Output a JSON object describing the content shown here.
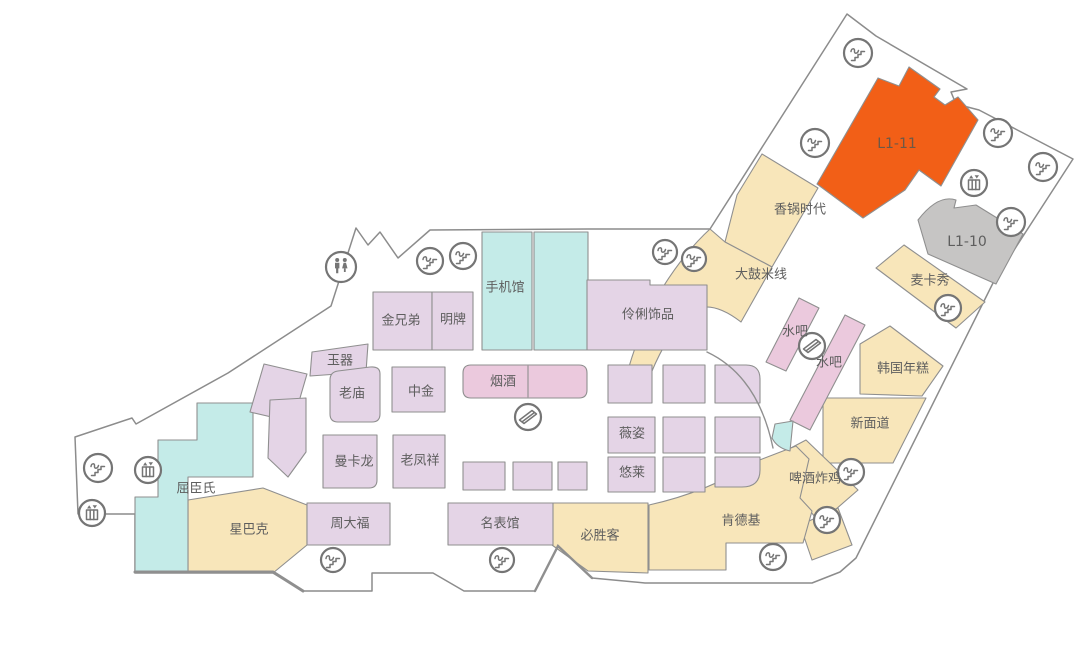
{
  "page": {
    "background": "#ffffff"
  },
  "map": {
    "width": 1089,
    "height": 652,
    "palette": {
      "floor": "#ffffff",
      "outline": "#8c8c8c",
      "tan": "#f8e6ba",
      "lavender": "#e4d4e6",
      "pink": "#ebc9dd",
      "cyan": "#c4ebe8",
      "orange": "#f25f17",
      "gray": "#c6c5c4",
      "room_stroke": "#8f8f8f",
      "label": "#5e5e5e",
      "icon": "#757575",
      "l1_11_text": "#6d5847"
    },
    "outline_path": "M75,437 L132,418 L136,424 L228,373 L331,306 L356,228 L368,245 L380,232 L398,258 L430,230 L588,229 L710,229 L847,14 L876,36 L967,89 L951,92 L956,104 L979,110 L1073,159 L994,281 L856,558 L840,572 L812,583 L645,583 L592,578 L558,546 L535,591 L464,591 L433,573 L372,573 L372,591 L303,591 L273,573 L135,573 L135,514 L78,514 Z",
    "rooms": [
      {
        "id": "xiangguoshidai",
        "label": "香锅时代",
        "fill": "tan",
        "path": "M737,195 L762,154 L818,188 L772,267 L725,242 Z",
        "lx": 800,
        "ly": 210
      },
      {
        "id": "dagumixian",
        "label": "大鼓米线",
        "fill": "tan",
        "path": "M710,229 L725,242 L772,267 L741,322 Q705,294 683,318 Q662,344 648,381 L628,370 Q642,322 663,287 Q685,252 710,229 Z",
        "lx": 761,
        "ly": 275
      },
      {
        "id": "l1-11",
        "label": "L1-11",
        "fill": "orange",
        "path": "M817,184 L878,78 L899,86 L909,67 L940,89 L934,97 L945,105 L958,97 L978,120 L941,186 L919,170 L905,190 L863,218 Z",
        "lx": 897,
        "ly": 144,
        "fs": 14,
        "tc": "l1_11_text"
      },
      {
        "id": "l1-10",
        "label": "L1-10",
        "fill": "gray",
        "path": "M918,220 Q938,194 956,200 L954,208 L976,205 L1023,234 L996,284 L928,254 Z",
        "lx": 967,
        "ly": 242,
        "fs": 14
      },
      {
        "id": "maikaxiu",
        "label": "麦卡秀",
        "fill": "tan",
        "path": "M876,268 L904,245 L985,302 L956,328 Z",
        "lx": 930,
        "ly": 281
      },
      {
        "id": "hanguoniangao",
        "label": "韩国年糕",
        "fill": "tan",
        "path": "M860,344 L890,326 L943,366 L922,396 L860,394 Z",
        "lx": 903,
        "ly": 369
      },
      {
        "id": "xinmiandao",
        "label": "新面道",
        "fill": "tan",
        "path": "M823,398 L926,398 L893,463 L823,463 Z",
        "lx": 870,
        "ly": 424
      },
      {
        "id": "shuiba-1",
        "label": "水吧",
        "fill": "pink",
        "path": "M766,362 L799,298 L819,308 L786,371 Z",
        "lx": 795,
        "ly": 332
      },
      {
        "id": "shuiba-2",
        "label": "水吧",
        "fill": "pink",
        "path": "M790,420 L845,315 L865,325 L810,430 Z",
        "lx": 829,
        "ly": 363
      },
      {
        "id": "pijiuzhaji",
        "label": "啤酒炸鸡",
        "fill": "tan",
        "path": "M768,460 L806,440 L858,490 L820,523 Z",
        "lx": 815,
        "ly": 479
      },
      {
        "id": "tan-annex",
        "label": "",
        "fill": "tan",
        "path": "M800,525 L838,508 L852,545 L812,560 Z"
      },
      {
        "id": "kendeji",
        "label": "肯德基",
        "fill": "tan",
        "path": "M649,505 Q708,492 757,461 L796,446 L809,459 L800,498 L812,511 L803,543 L726,543 L726,570 L649,570 Z",
        "lx": 741,
        "ly": 521
      },
      {
        "id": "bishengke",
        "label": "必胜客",
        "fill": "tan",
        "path": "M552,503 L648,503 L648,573 L588,571 L552,545 Z",
        "lx": 600,
        "ly": 536
      },
      {
        "id": "xingbake",
        "label": "星巴克",
        "fill": "tan",
        "path": "M188,500 L263,488 L307,505 L307,545 L273,573 L188,573 Z",
        "lx": 249,
        "ly": 530
      },
      {
        "id": "quchenshi",
        "label": "屈臣氏",
        "fill": "cyan",
        "path": "M197,403 L253,403 L253,477 L188,477 L188,573 L135,573 L135,497 L158,497 L158,440 L197,440 Z",
        "lx": 196,
        "ly": 489
      },
      {
        "id": "shoujiguan",
        "label": "手机馆",
        "fill": "cyan",
        "path": "M482,232 L532,232 L532,350 L482,350 Z",
        "lx": 505,
        "ly": 288
      },
      {
        "id": "shoujiguan-2",
        "label": "",
        "fill": "cyan",
        "path": "M534,232 L588,232 L588,350 L534,350 Z"
      },
      {
        "id": "jinxiongdi",
        "label": "金兄弟",
        "fill": "lavender",
        "path": "M373,292 L432,292 L432,350 L373,350 Z",
        "lx": 401,
        "ly": 321
      },
      {
        "id": "mingpai",
        "label": "明牌",
        "fill": "lavender",
        "path": "M432,292 L473,292 L473,350 L432,350 Z",
        "lx": 453,
        "ly": 320
      },
      {
        "id": "linglishipin",
        "label": "伶俐饰品",
        "fill": "lavender",
        "path": "M587,280 L650,280 L650,285 L707,285 L707,350 L587,350 Z",
        "lx": 648,
        "ly": 315
      },
      {
        "id": "yuqi",
        "label": "玉器",
        "fill": "lavender",
        "path": "M312,352 L368,344 L366,372 L310,376 Z",
        "lx": 340,
        "ly": 361
      },
      {
        "id": "laomiao",
        "label": "老庙",
        "fill": "lavender",
        "path": "M330,380 Q330,372 338,371 L370,367 Q380,366 380,374 L380,414 Q380,422 372,422 L338,422 Q330,422 330,414 Z",
        "lx": 352,
        "ly": 394
      },
      {
        "id": "zhongjin",
        "label": "中金",
        "fill": "lavender",
        "path": "M392,367 L445,367 L445,412 L392,412 Z",
        "lx": 421,
        "ly": 392
      },
      {
        "id": "yanjiu",
        "label": "烟酒",
        "fill": "pink",
        "path": "M471,365 L579,365 Q587,365 587,373 L587,390 Q587,398 579,398 L471,398 Q463,398 463,390 L463,373 Q463,365 471,365 Z",
        "lx": 503,
        "ly": 382
      },
      {
        "id": "mankalong",
        "label": "曼卡龙",
        "fill": "lavender",
        "path": "M323,435 L377,435 L377,480 Q377,488 369,488 L323,488 Z",
        "lx": 354,
        "ly": 462
      },
      {
        "id": "laofengxiang",
        "label": "老凤祥",
        "fill": "lavender",
        "path": "M393,435 L445,435 L445,488 L393,488 Z",
        "lx": 420,
        "ly": 461
      },
      {
        "id": "zhoudafu",
        "label": "周大福",
        "fill": "lavender",
        "path": "M307,503 L390,503 L390,545 L307,545 Z",
        "lx": 350,
        "ly": 524
      },
      {
        "id": "mingbiaoguan",
        "label": "名表馆",
        "fill": "lavender",
        "path": "M448,503 L553,503 L553,545 L448,545 Z",
        "lx": 500,
        "ly": 524
      },
      {
        "id": "weizi",
        "label": "薇姿",
        "fill": "lavender",
        "path": "M608,417 L655,417 L655,453 L608,453 Z",
        "lx": 632,
        "ly": 434
      },
      {
        "id": "youlai",
        "label": "悠莱",
        "fill": "lavender",
        "path": "M608,457 L655,457 L655,492 L608,492 Z",
        "lx": 632,
        "ly": 473
      },
      {
        "id": "diag-1",
        "label": "",
        "fill": "lavender",
        "path": "M250,412 L264,364 L307,374 L293,422 Z"
      },
      {
        "id": "diag-2",
        "label": "",
        "fill": "lavender",
        "path": "M270,400 L306,398 L306,452 L288,477 L268,458 Z"
      },
      {
        "id": "grid-1",
        "label": "",
        "fill": "lavender",
        "path": "M608,365 L652,365 L652,403 L608,403 Z"
      },
      {
        "id": "grid-2",
        "label": "",
        "fill": "lavender",
        "path": "M663,365 L705,365 L705,403 L663,403 Z"
      },
      {
        "id": "grid-3",
        "label": "",
        "fill": "lavender",
        "path": "M715,365 L746,365 Q760,365 760,379 L760,403 L715,403 Z"
      },
      {
        "id": "grid-4",
        "label": "",
        "fill": "lavender",
        "path": "M663,417 L705,417 L705,453 L663,453 Z"
      },
      {
        "id": "grid-5",
        "label": "",
        "fill": "lavender",
        "path": "M715,417 L760,417 L760,453 L715,453 Z"
      },
      {
        "id": "grid-6",
        "label": "",
        "fill": "lavender",
        "path": "M663,457 L705,457 L705,492 L663,492 Z"
      },
      {
        "id": "grid-7",
        "label": "",
        "fill": "lavender",
        "path": "M715,457 L760,457 L760,470 Q760,487 742,487 L715,487 Z"
      },
      {
        "id": "small-1",
        "label": "",
        "fill": "lavender",
        "path": "M463,462 L505,462 L505,490 L463,490 Z"
      },
      {
        "id": "small-2",
        "label": "",
        "fill": "lavender",
        "path": "M513,462 L552,462 L552,490 L513,490 Z"
      },
      {
        "id": "small-3",
        "label": "",
        "fill": "lavender",
        "path": "M558,462 L587,462 L587,490 L558,490 Z"
      },
      {
        "id": "cyan-wedge",
        "label": "",
        "fill": "cyan",
        "path": "M775,424 L793,421 L790,451 Q777,448 772,438 Z"
      }
    ],
    "lines": [
      {
        "d": "M528,366 L528,397",
        "w": 1.1
      },
      {
        "d": "M707,352 Q758,376 773,448",
        "w": 1.4
      },
      {
        "d": "M135,572 L273,572 L303,591",
        "w": 3
      },
      {
        "d": "M535,591 L558,546 L592,578",
        "w": 2.4
      }
    ],
    "icons": [
      {
        "type": "escalator",
        "x": 430,
        "y": 261,
        "r": 13
      },
      {
        "type": "escalator",
        "x": 463,
        "y": 256,
        "r": 13
      },
      {
        "type": "restroom",
        "x": 341,
        "y": 267,
        "r": 15
      },
      {
        "type": "escalator",
        "x": 665,
        "y": 252,
        "r": 12
      },
      {
        "type": "escalator",
        "x": 694,
        "y": 259,
        "r": 12
      },
      {
        "type": "escalator",
        "x": 858,
        "y": 53,
        "r": 14
      },
      {
        "type": "escalator",
        "x": 815,
        "y": 143,
        "r": 14
      },
      {
        "type": "escalator",
        "x": 998,
        "y": 133,
        "r": 14
      },
      {
        "type": "escalator",
        "x": 1043,
        "y": 167,
        "r": 14
      },
      {
        "type": "elevator",
        "x": 974,
        "y": 183,
        "r": 13
      },
      {
        "type": "escalator",
        "x": 1011,
        "y": 222,
        "r": 14
      },
      {
        "type": "escalator",
        "x": 948,
        "y": 308,
        "r": 13
      },
      {
        "type": "walkway",
        "x": 812,
        "y": 346,
        "r": 13
      },
      {
        "type": "walkway",
        "x": 528,
        "y": 417,
        "r": 13
      },
      {
        "type": "escalator",
        "x": 851,
        "y": 472,
        "r": 13
      },
      {
        "type": "escalator",
        "x": 827,
        "y": 520,
        "r": 13
      },
      {
        "type": "escalator",
        "x": 773,
        "y": 557,
        "r": 13
      },
      {
        "type": "escalator",
        "x": 333,
        "y": 560,
        "r": 12
      },
      {
        "type": "escalator",
        "x": 502,
        "y": 560,
        "r": 12
      },
      {
        "type": "escalator",
        "x": 98,
        "y": 468,
        "r": 14
      },
      {
        "type": "elevator",
        "x": 148,
        "y": 470,
        "r": 13
      },
      {
        "type": "elevator",
        "x": 92,
        "y": 513,
        "r": 13
      }
    ]
  }
}
